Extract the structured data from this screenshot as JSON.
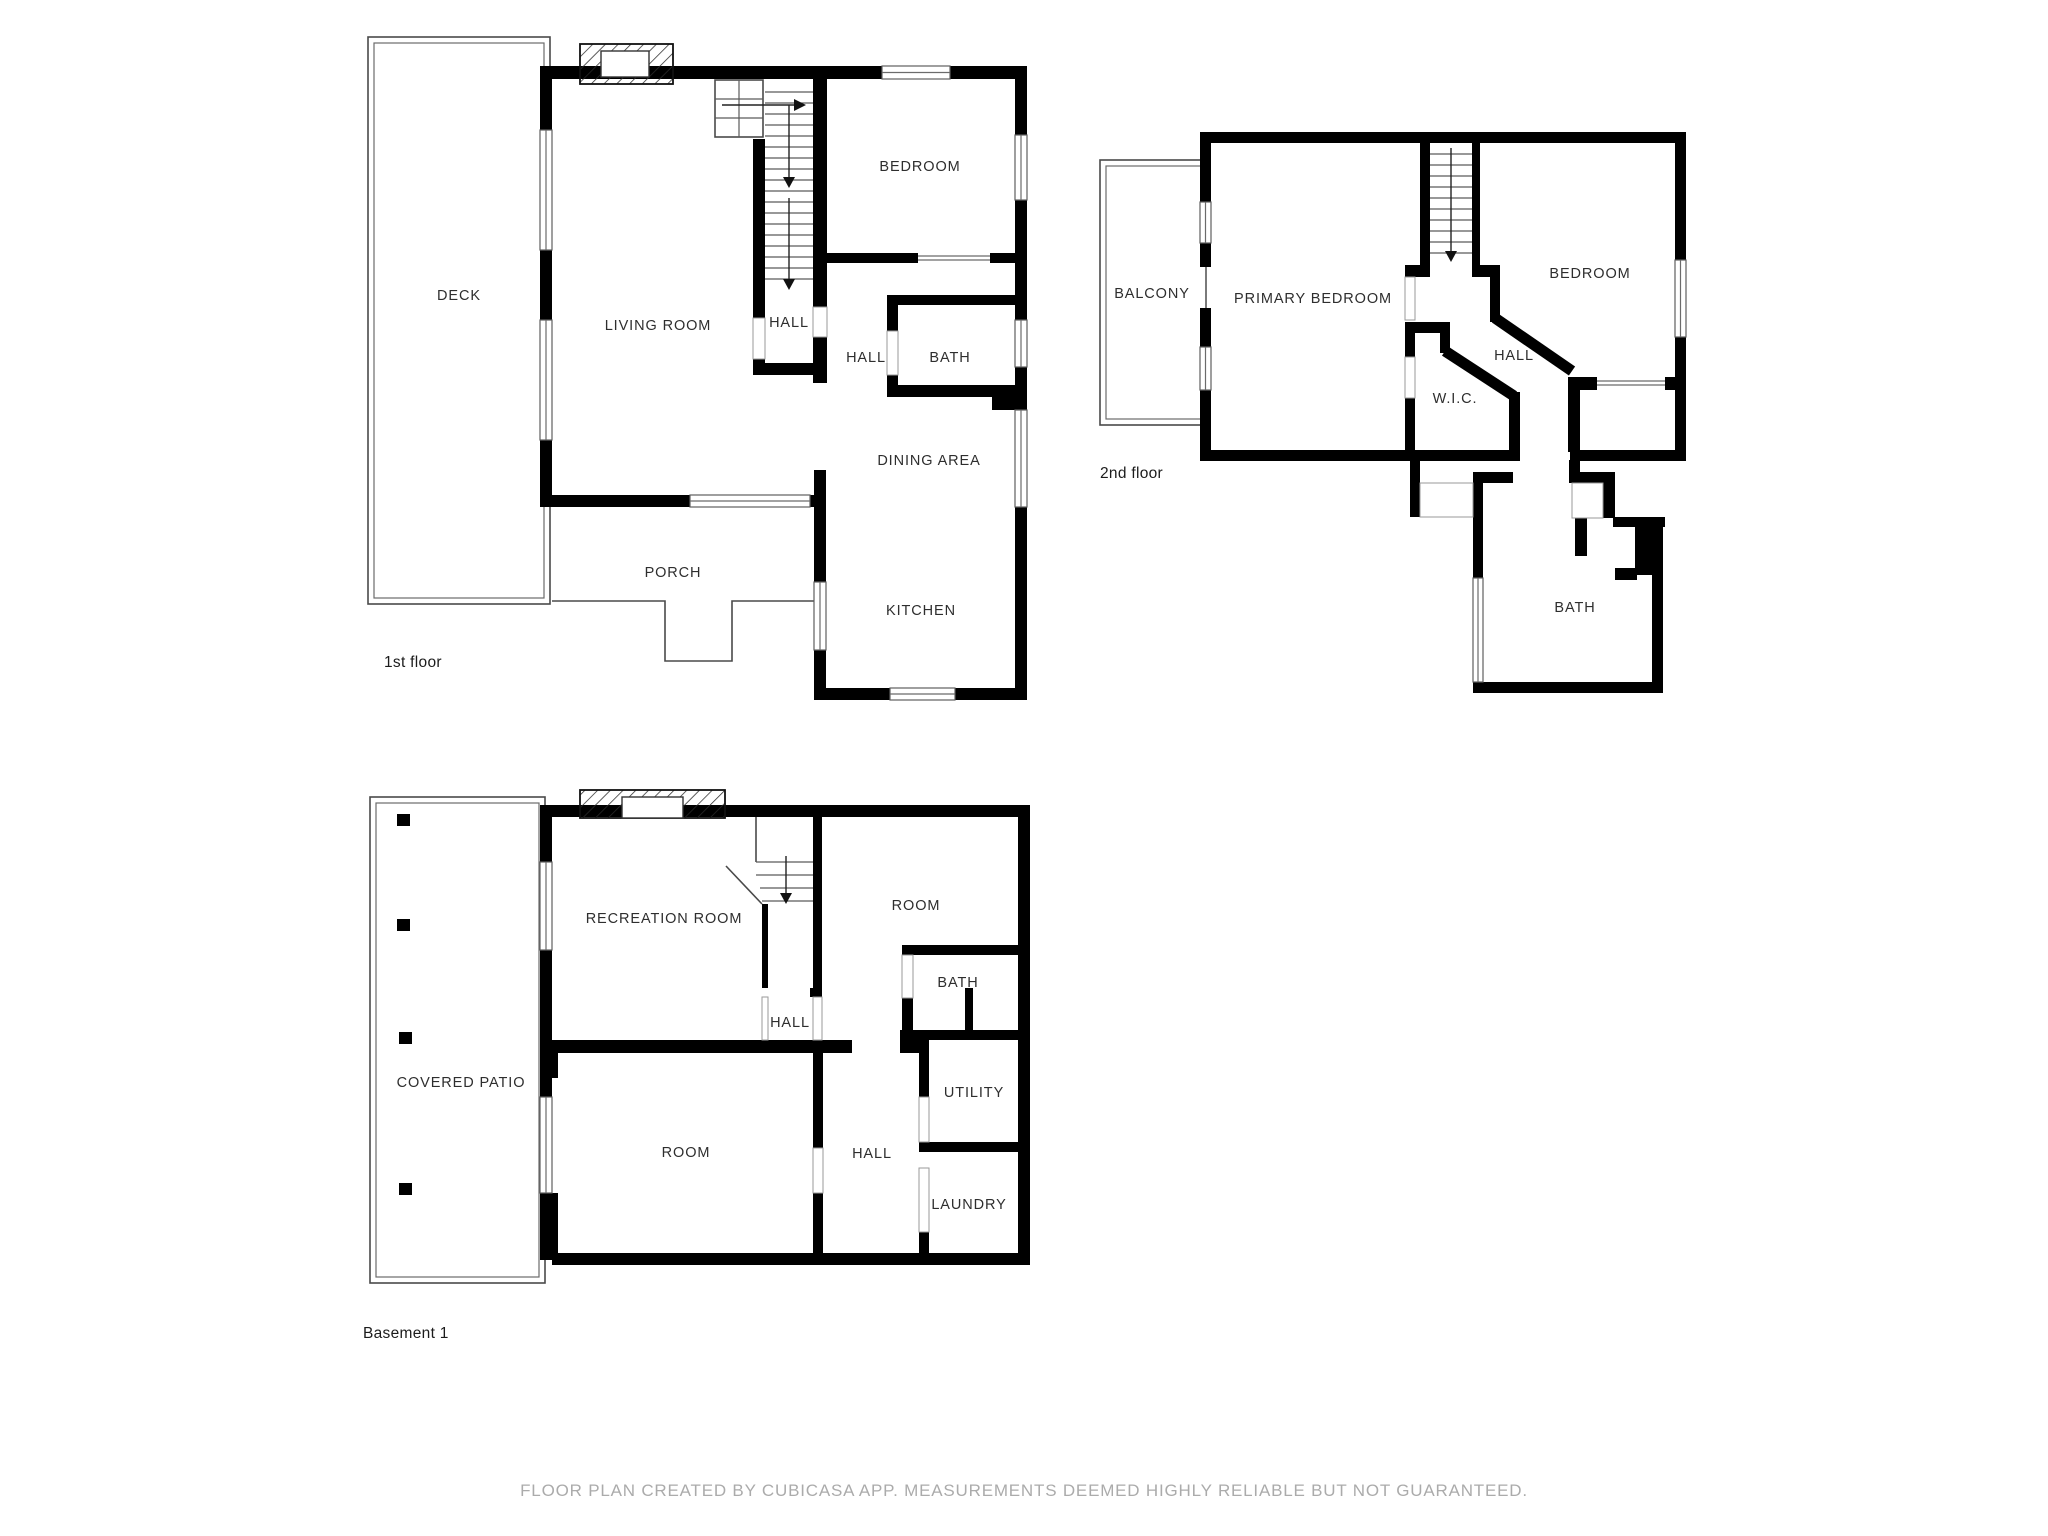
{
  "footer": {
    "text": "FLOOR PLAN CREATED BY CUBICASA APP. MEASUREMENTS DEEMED HIGHLY RELIABLE BUT NOT GUARANTEED."
  },
  "colors": {
    "wall": "#000000",
    "thin_outline": "#4a4a4a",
    "room_label": "#2e2e2e",
    "footer_text": "#ababab"
  },
  "floors": {
    "first": {
      "label": "1st floor",
      "rooms": {
        "deck": "DECK",
        "living_room": "LIVING ROOM",
        "hall_stairs": "HALL",
        "hall": "HALL",
        "bath": "BATH",
        "bedroom": "BEDROOM",
        "dining_area": "DINING AREA",
        "kitchen": "KITCHEN",
        "porch": "PORCH"
      }
    },
    "second": {
      "label": "2nd floor",
      "rooms": {
        "balcony": "BALCONY",
        "primary_bedroom": "PRIMARY BEDROOM",
        "bedroom": "BEDROOM",
        "hall": "HALL",
        "wic": "W.I.C.",
        "bath": "BATH"
      }
    },
    "basement": {
      "label": "Basement 1",
      "rooms": {
        "recreation_room": "RECREATION ROOM",
        "room_upper": "ROOM",
        "bath": "BATH",
        "hall_upper": "HALL",
        "covered_patio": "COVERED PATIO",
        "room_lower": "ROOM",
        "hall_lower": "HALL",
        "utility": "UTILITY",
        "laundry": "LAUNDRY"
      }
    }
  }
}
